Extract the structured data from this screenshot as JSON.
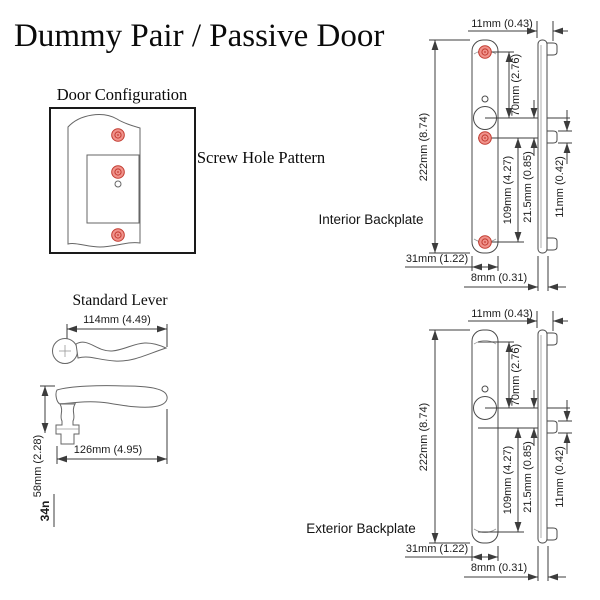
{
  "title": "Dummy Pair / Passive Door",
  "door_configuration": {
    "label": "Door Configuration",
    "screw_hole_pattern": "Screw Hole Pattern"
  },
  "lever": {
    "label": "Standard Lever",
    "top_length": "114mm (4.49)",
    "side_length": "126mm (4.95)",
    "side_height": "58mm (2.28)",
    "partial_dim": "34n"
  },
  "interior": {
    "label": "Interior Backplate"
  },
  "exterior": {
    "label": "Exterior Backplate"
  },
  "dims": {
    "top_width": "11mm (0.43)",
    "upper_span": "70mm (2.76)",
    "total_height": "222mm (8.74)",
    "lower_span": "109mm (4.27)",
    "mid_offset": "21.5mm (0.85)",
    "tab_height": "11mm (0.42)",
    "plate_width": "31mm (1.22)",
    "plate_depth": "8mm (0.31)"
  },
  "colors": {
    "screw_hole_fill": "#f0928b",
    "screw_hole_ring": "#c23b30",
    "line_color": "#3c3c3c"
  }
}
